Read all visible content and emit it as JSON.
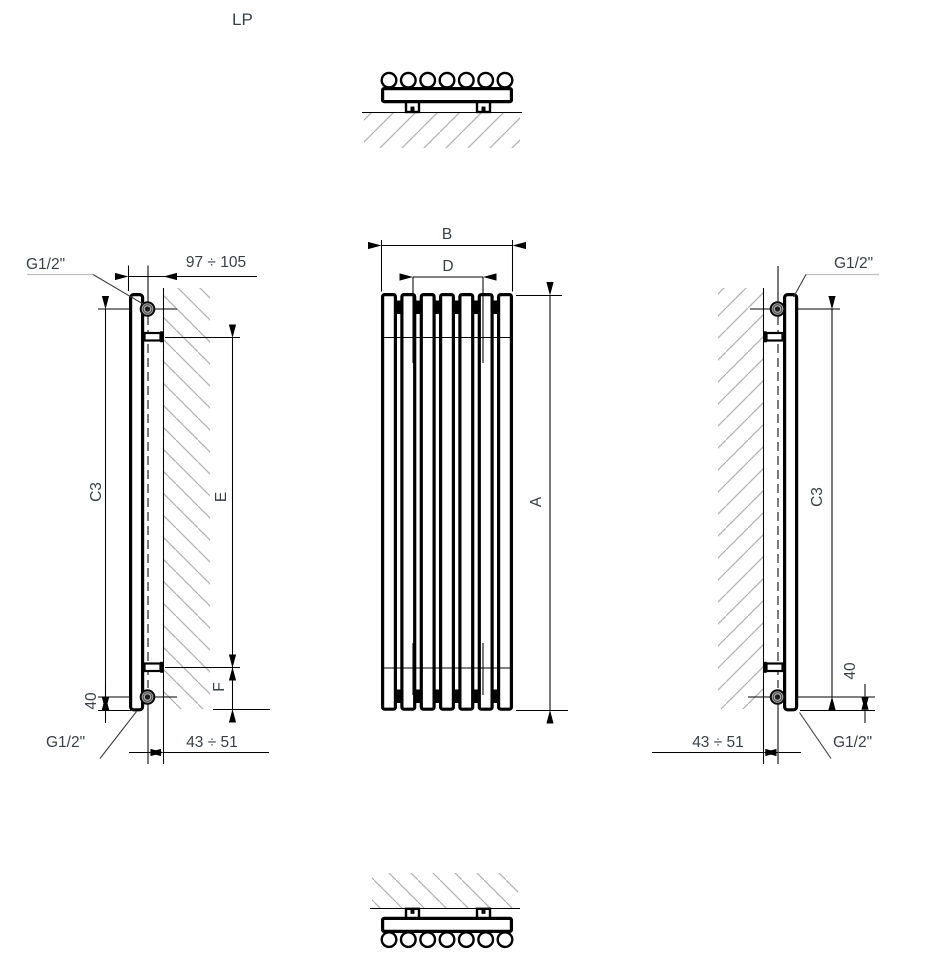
{
  "drawing": {
    "model_label": "LP",
    "front": {
      "width_dim": "B",
      "spacing_dim": "D",
      "height_dim": "A"
    },
    "left": {
      "top_connection": "G1/2\"",
      "bottom_connection": "G1/2\"",
      "wall_distance": "97 ÷ 105",
      "axis_height": "C3",
      "bracket_span": "E",
      "bracket_bottom_offset": "F",
      "bottom_axis_offset": "40",
      "axis_wall_distance": "43 ÷ 51"
    },
    "right": {
      "top_connection": "G1/2\"",
      "bottom_connection": "G1/2\"",
      "axis_height": "C3",
      "bottom_axis_offset": "40",
      "axis_wall_distance": "43 ÷ 51"
    }
  }
}
